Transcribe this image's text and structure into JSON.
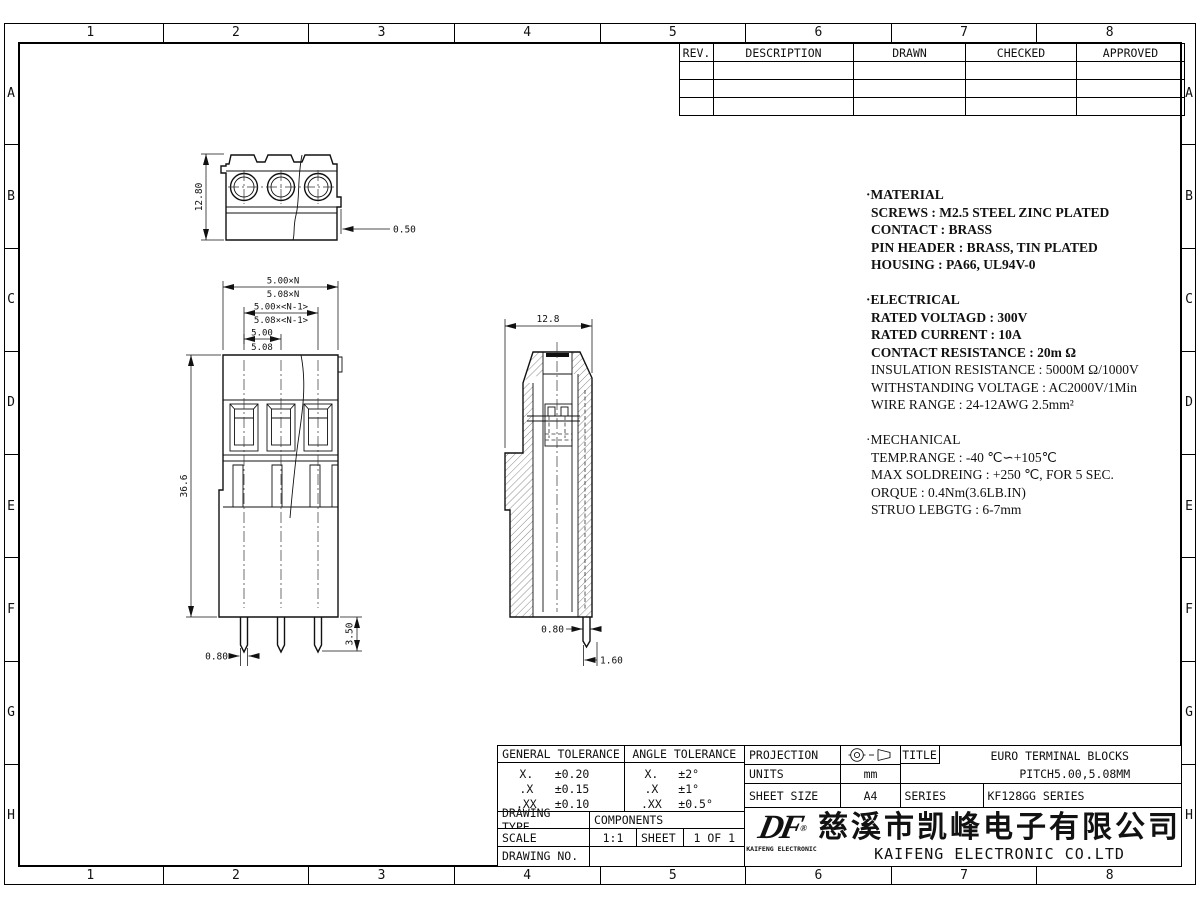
{
  "border": {
    "cols": [
      "1",
      "2",
      "3",
      "4",
      "5",
      "6",
      "7",
      "8"
    ],
    "rows": [
      "A",
      "B",
      "C",
      "D",
      "E",
      "F",
      "G",
      "H"
    ]
  },
  "rev_table": {
    "headers": [
      "REV.",
      "DESCRIPTION",
      "DRAWN",
      "CHECKED",
      "APPROVED"
    ]
  },
  "notes": {
    "material": {
      "title": "·MATERIAL",
      "lines": [
        "SCREWS :  M2.5 STEEL ZINC PLATED",
        "CONTACT :  BRASS",
        "PIN HEADER :  BRASS, TIN PLATED",
        "HOUSING :  PA66, UL94V-0"
      ]
    },
    "electrical": {
      "title": "·ELECTRICAL",
      "lines": [
        "RATED VOLTAGD :  300V",
        "RATED CURRENT :  10A",
        "CONTACT RESISTANCE :  20m Ω",
        "INSULATION RESISTANCE :  5000M Ω/1000V",
        "WITHSTANDING VOLTAGE :  AC2000V/1Min",
        "WIRE RANGE :  24-12AWG 2.5mm²"
      ]
    },
    "mechanical": {
      "title": "·MECHANICAL",
      "lines": [
        "TEMP.RANGE :  -40 ℃∽+105℃",
        "MAX SOLDREING :  +250 ℃, FOR 5 SEC.",
        "ORQUE :  0.4Nm(3.6LB.IN)",
        "STRUO LEBGTG :  6-7mm"
      ]
    }
  },
  "dims": {
    "top_height": "12.80",
    "top_step": "0.50",
    "front_pitch_total_a": "5.00×N",
    "front_pitch_total_b": "5.08×N",
    "front_pitch_n1_a": "5.00×<N-1>",
    "front_pitch_n1_b": "5.08×<N-1>",
    "front_pitch_a": "5.00",
    "front_pitch_b": "5.08",
    "front_height": "36.6",
    "front_pin_len": "3.50",
    "front_pin_w": "0.80",
    "side_width": "12.8",
    "side_pin_w": "0.80",
    "side_pin_off": "1.60"
  },
  "title_block": {
    "general_tolerance": {
      "title": "GENERAL  TOLERANCE",
      "rows": [
        [
          "X.",
          "±0.20"
        ],
        [
          ".X",
          "±0.15"
        ],
        [
          ".XX",
          "±0.10"
        ]
      ]
    },
    "angle_tolerance": {
      "title": "ANGLE  TOLERANCE",
      "rows": [
        [
          "X.",
          "±2°"
        ],
        [
          ".X",
          "±1°"
        ],
        [
          ".XX",
          "±0.5°"
        ]
      ]
    },
    "drawing_type_label": "DRAWING  TYPE",
    "drawing_type_value": "COMPONENTS",
    "scale_label": "SCALE",
    "scale_value": "1:1",
    "sheet_label": "SHEET",
    "sheet_value": "1  OF  1",
    "drawing_no_label": "DRAWING  NO.",
    "drawing_no_value": "",
    "projection_label": "PROJECTION",
    "units_label": "UNITS",
    "units_value": "mm",
    "sheet_size_label": "SHEET  SIZE",
    "sheet_size_value": "A4",
    "title_label": "TITLE",
    "title_line1": "EURO  TERMINAL  BLOCKS",
    "title_line2": "PITCH5.00,5.08MM",
    "series_label": "SERIES",
    "series_value": "KF128GG    SERIES",
    "company": {
      "logo_text": "DF",
      "reg_mark": "®",
      "logo_sub": "KAIFENG  ELECTRONIC",
      "name_cn": "慈溪市凯峰电子有限公司",
      "name_en": "KAIFENG  ELECTRONIC  CO.LTD"
    }
  }
}
